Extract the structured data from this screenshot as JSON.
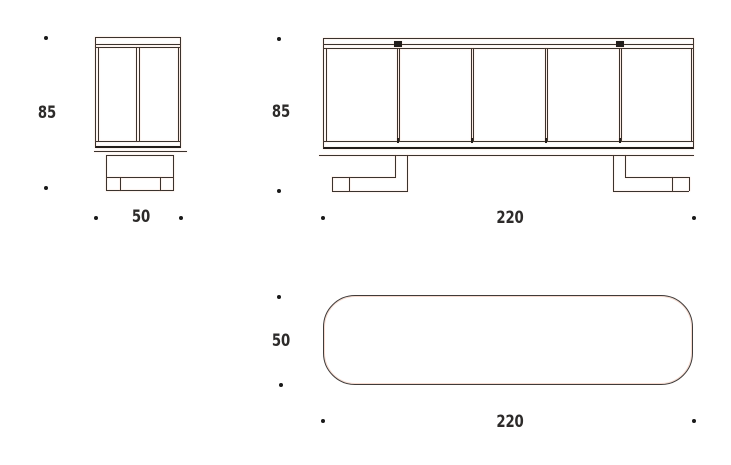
{
  "title": "sideboard technical dimension drawing",
  "colors": {
    "bg": "#ffffff",
    "line": "#3a322d",
    "line_dark": "#221d1a",
    "plan_line": "#403b39",
    "halo": "#e89c7673",
    "dot": "#191919",
    "text": "#2d2b2a"
  },
  "views": {
    "side": {
      "height_label": "85",
      "width_label": "50"
    },
    "front": {
      "height_label": "85",
      "width_label": "220"
    },
    "plan": {
      "depth_label": "50",
      "width_label": "220"
    }
  }
}
